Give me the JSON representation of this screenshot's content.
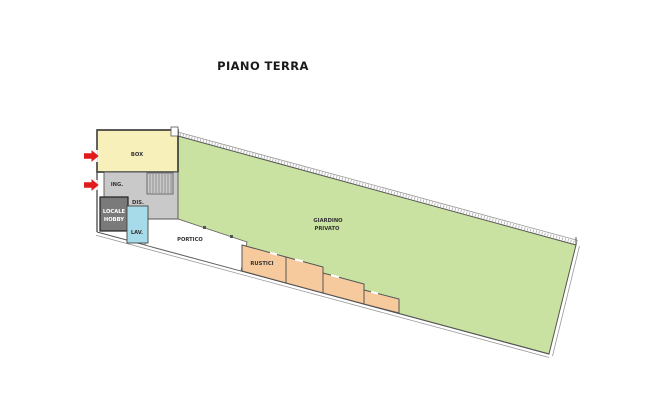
{
  "title": "PIANO TERRA",
  "labels": {
    "box": "BOX",
    "ing": "ING.",
    "dis": "DIS.",
    "hobby_line1": "LOCALE",
    "hobby_line2": "HOBBY",
    "lav": "LAV.",
    "portico": "PORTICO",
    "rustici": "RUSTICI",
    "garden_line1": "GIARDINO",
    "garden_line2": "PRIVATO"
  },
  "colors": {
    "garden": "#c9e2a1",
    "box": "#f7f0bb",
    "circulation": "#c9c9c9",
    "hobby": "#7a7a7a",
    "laundry": "#a8dbea",
    "rustici": "#f6ca9d",
    "arrow": "#e11b1b",
    "wall": "#555555"
  }
}
